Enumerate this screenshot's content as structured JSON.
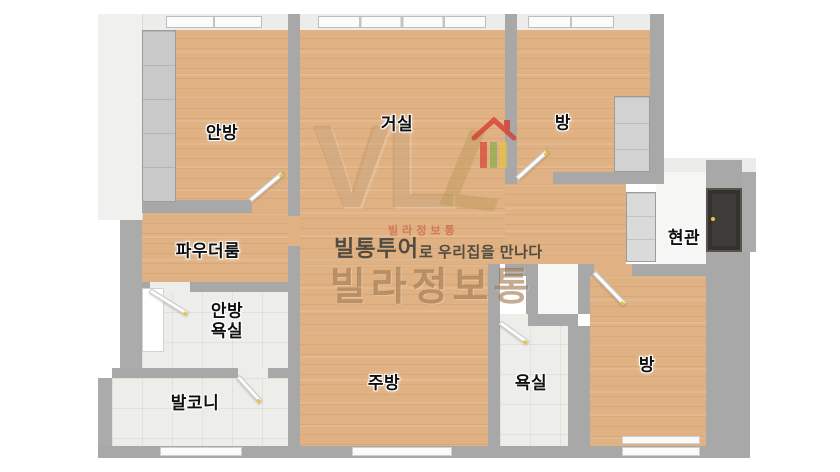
{
  "rooms": {
    "master_bedroom": "안방",
    "living_room": "거실",
    "room_top_right": "방",
    "entrance": "현관",
    "powder_room": "파우더룸",
    "master_bathroom_line1": "안방",
    "master_bathroom_line2": "욕실",
    "balcony": "발코니",
    "kitchen": "주방",
    "bathroom": "욕실",
    "room_bottom_right": "방"
  },
  "watermark": {
    "logo_letters": "VL",
    "logo_letter_slant": "L",
    "brand_small_red": "빌라정보통",
    "tagline_brand": "빌통투어",
    "tagline_rest": "로 우리집을 만나다",
    "brand_large": "빌라정보통"
  },
  "colors": {
    "wood_floor": "#E0B283",
    "tile_floor": "#EDEDEA",
    "wall_gray": "#A8A8A8",
    "wall_light": "#ECECEB",
    "front_door_dark": "#3E3C38",
    "accent_red": "#D6372B",
    "accent_green": "#7BAE3F",
    "accent_yellow": "#E8C43A",
    "watermark_tan": "#BE915F",
    "watermark_text_dark": "#383836"
  }
}
